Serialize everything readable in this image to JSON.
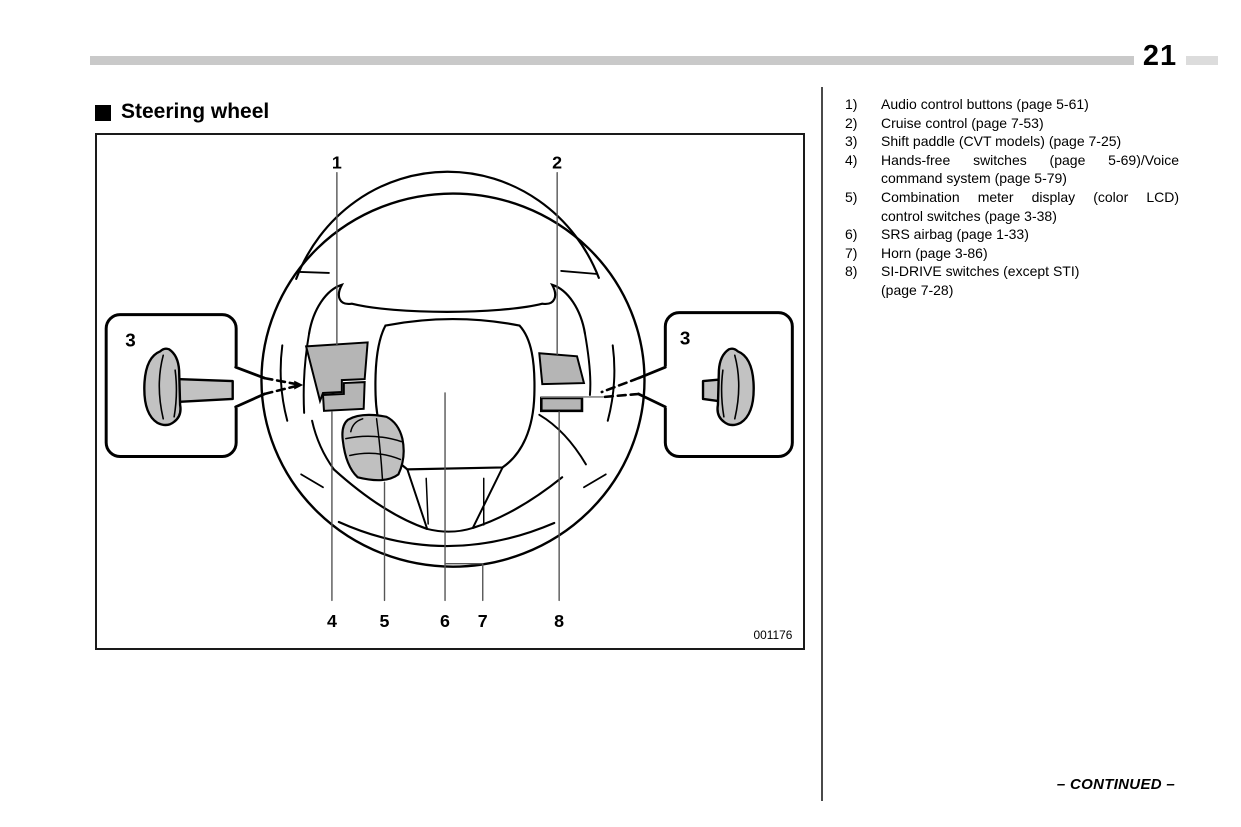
{
  "page": {
    "number": "21",
    "continued_label": "– CONTINUED –"
  },
  "header": {
    "marker_icon": "black-square",
    "title": "Steering wheel"
  },
  "figure": {
    "code": "001176",
    "callouts": {
      "c1": "1",
      "c2": "2",
      "c3_left": "3",
      "c3_right": "3",
      "c4": "4",
      "c5": "5",
      "c6": "6",
      "c7": "7",
      "c8": "8"
    }
  },
  "legend": {
    "items": [
      {
        "num": "1)",
        "lines": [
          "Audio control buttons (page 5-61)"
        ],
        "justify": false
      },
      {
        "num": "2)",
        "lines": [
          "Cruise control (page 7-53)"
        ],
        "justify": false
      },
      {
        "num": "3)",
        "lines": [
          "Shift paddle (CVT models) (page 7-25)"
        ],
        "justify": false
      },
      {
        "num": "4)",
        "lines": [
          "Hands-free switches (page 5-69)/Voice",
          "command system (page 5-79)"
        ],
        "justify": true
      },
      {
        "num": "5)",
        "lines": [
          "Combination meter display (color LCD)",
          "control switches (page 3-38)"
        ],
        "justify": true
      },
      {
        "num": "6)",
        "lines": [
          "SRS airbag (page 1-33)"
        ],
        "justify": false
      },
      {
        "num": "7)",
        "lines": [
          "Horn (page 3-86)"
        ],
        "justify": false
      },
      {
        "num": "8)",
        "lines": [
          "SI-DRIVE switches (except STI)",
          "(page 7-28)"
        ],
        "justify": false
      }
    ]
  },
  "colors": {
    "top_bar_gray": "#c9c9c9",
    "panel_gray": "#b5b5b5",
    "paddle_gray": "#c2c2c2",
    "stalk_gray": "#c0c0c0"
  }
}
